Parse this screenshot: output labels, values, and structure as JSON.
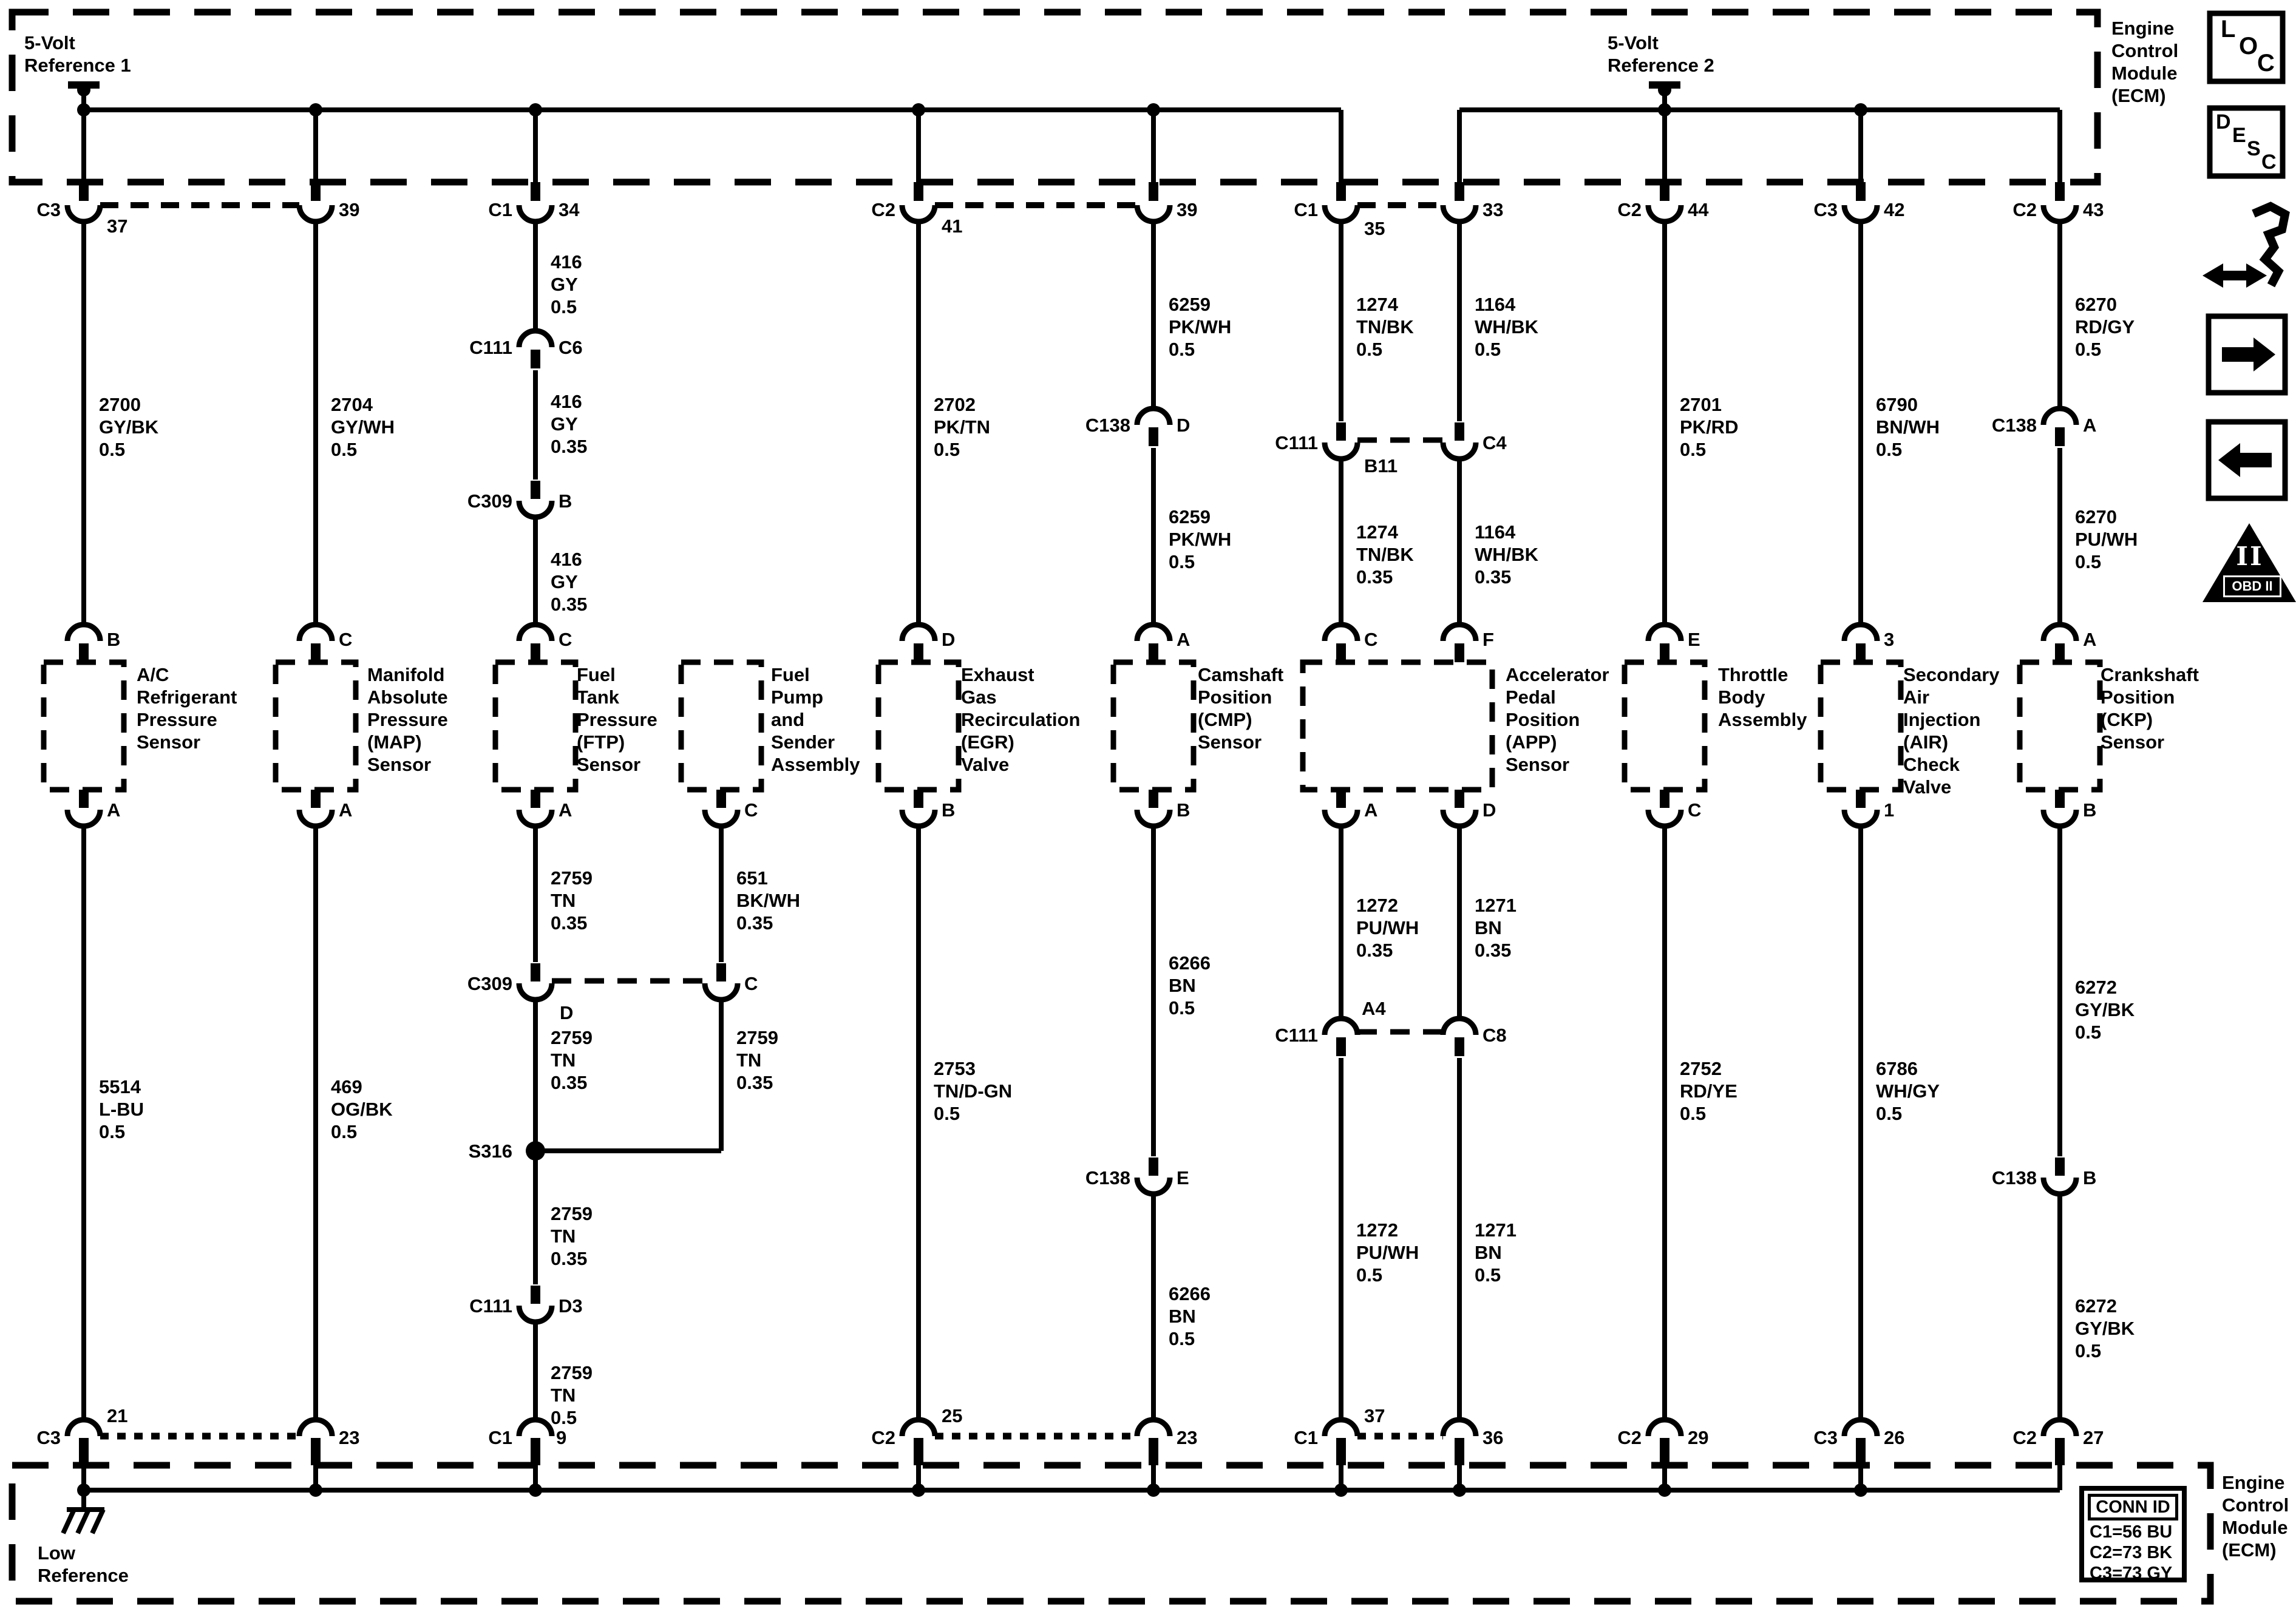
{
  "diagram": {
    "ref1": "5-Volt\nReference 1",
    "ref2": "5-Volt\nReference 2",
    "ecm_top": "Engine\nControl\nModule\n(ECM)",
    "ecm_bottom": "Engine\nControl\nModule\n(ECM)",
    "low_reference": "Low\nReference",
    "splice": "S316"
  },
  "top_pins": [
    {
      "conn": "C3",
      "pin": "37"
    },
    {
      "conn": "",
      "pin": "39"
    },
    {
      "conn": "C1",
      "pin": "34"
    },
    {
      "conn": "C2",
      "pin": "41"
    },
    {
      "conn": "",
      "pin": "39"
    },
    {
      "conn": "C1",
      "pin": "35"
    },
    {
      "conn": "",
      "pin": "33"
    },
    {
      "conn": "C2",
      "pin": "44"
    },
    {
      "conn": "C3",
      "pin": "42"
    },
    {
      "conn": "C2",
      "pin": "43"
    }
  ],
  "bottom_pins": [
    {
      "conn": "C3",
      "pin": "21"
    },
    {
      "conn": "",
      "pin": "23"
    },
    {
      "conn": "C1",
      "pin": "9"
    },
    {
      "conn": "C2",
      "pin": "25"
    },
    {
      "conn": "",
      "pin": "23"
    },
    {
      "conn": "C1",
      "pin": "37"
    },
    {
      "conn": "",
      "pin": "36"
    },
    {
      "conn": "C2",
      "pin": "29"
    },
    {
      "conn": "C3",
      "pin": "26"
    },
    {
      "conn": "C2",
      "pin": "27"
    }
  ],
  "w_top": {
    "a": "2700\nGY/BK\n0.5",
    "b": "2704\nGY/WH\n0.5",
    "c1": "416\nGY\n0.5",
    "c2": "416\nGY\n0.35",
    "c3": "416\nGY\n0.35",
    "d": "2702\nPK/TN\n0.5",
    "e1": "6259\nPK/WH\n0.5",
    "e2": "6259\nPK/WH\n0.5",
    "f1": "1274\nTN/BK\n0.5",
    "f2": "1274\nTN/BK\n0.35",
    "g1": "1164\nWH/BK\n0.5",
    "g2": "1164\nWH/BK\n0.35",
    "h": "2701\nPK/RD\n0.5",
    "i": "6790\nBN/WH\n0.5",
    "j1": "6270\nRD/GY\n0.5",
    "j2": "6270\nPU/WH\n0.5"
  },
  "w_bot": {
    "a": "5514\nL-BU\n0.5",
    "b": "469\nOG/BK\n0.5",
    "c1": "2759\nTN\n0.35",
    "c2": "2759\nTN\n0.35",
    "c3": "2759\nTN\n0.35",
    "c4": "2759\nTN\n0.5",
    "fp1": "651\nBK/WH\n0.35",
    "fp2": "2759\nTN\n0.35",
    "d": "2753\nTN/D-GN\n0.5",
    "e1": "6266\nBN\n0.5",
    "e2": "6266\nBN\n0.5",
    "f1": "1272\nPU/WH\n0.35",
    "f2": "1272\nPU/WH\n0.5",
    "g1": "1271\nBN\n0.35",
    "g2": "1271\nBN\n0.5",
    "h": "2752\nRD/YE\n0.5",
    "i": "6786\nWH/GY\n0.5",
    "j1": "6272\nGY/BK\n0.5",
    "j2": "6272\nGY/BK\n0.5"
  },
  "ic": {
    "c111_c6": {
      "conn": "C111",
      "pin": "C6"
    },
    "c309_b": {
      "conn": "C309",
      "pin": "B"
    },
    "c138_d": {
      "conn": "C138",
      "pin": "D"
    },
    "c111_b11": {
      "conn": "C111",
      "pin": "B11"
    },
    "c4": {
      "pin": "C4"
    },
    "c138_a": {
      "conn": "C138",
      "pin": "A"
    },
    "c309_d": {
      "conn": "C309",
      "pin": "D"
    },
    "c309_c": {
      "pin": "C"
    },
    "c111_d3": {
      "conn": "C111",
      "pin": "D3"
    },
    "c138_e": {
      "conn": "C138",
      "pin": "E"
    },
    "c111_a4": {
      "conn": "C111",
      "pin": "A4"
    },
    "c8": {
      "pin": "C8"
    },
    "c138_b": {
      "conn": "C138",
      "pin": "B"
    }
  },
  "devices": [
    {
      "name": "A/C\nRefrigerant\nPressure\nSensor",
      "top": "B",
      "bottom": "A"
    },
    {
      "name": "Manifold\nAbsolute\nPressure\n(MAP)\nSensor",
      "top": "C",
      "bottom": "A"
    },
    {
      "name": "Fuel\nTank\nPressure\n(FTP)\nSensor",
      "top": "C",
      "bottom": "A"
    },
    {
      "name": "Fuel\nPump\nand\nSender\nAssembly",
      "top": "",
      "bottom": "C"
    },
    {
      "name": "Exhaust\nGas\nRecirculation\n(EGR)\nValve",
      "top": "D",
      "bottom": "B"
    },
    {
      "name": "Camshaft\nPosition\n(CMP)\nSensor",
      "top": "A",
      "bottom": "B"
    },
    {
      "name": "Accelerator\nPedal\nPosition\n(APP)\nSensor",
      "top": "C",
      "top2": "F",
      "bottom": "A",
      "bottom2": "D"
    },
    {
      "name": "Throttle\nBody\nAssembly",
      "top": "E",
      "bottom": "C"
    },
    {
      "name": "Secondary\nAir\nInjection\n(AIR)\nCheck\nValve",
      "top": "3",
      "bottom": "1"
    },
    {
      "name": "Crankshaft\nPosition\n(CKP)\nSensor",
      "top": "A",
      "bottom": "B"
    }
  ],
  "conn_id": {
    "header": "CONN ID",
    "rows": [
      "C1=56 BU",
      "C2=73 BK",
      "C3=73 GY"
    ]
  },
  "icons": {
    "loc": [
      "L",
      "O",
      "C"
    ],
    "desc": [
      "D",
      "E",
      "S",
      "C"
    ],
    "obd_glyph": "II",
    "obd_label": "OBD II"
  }
}
